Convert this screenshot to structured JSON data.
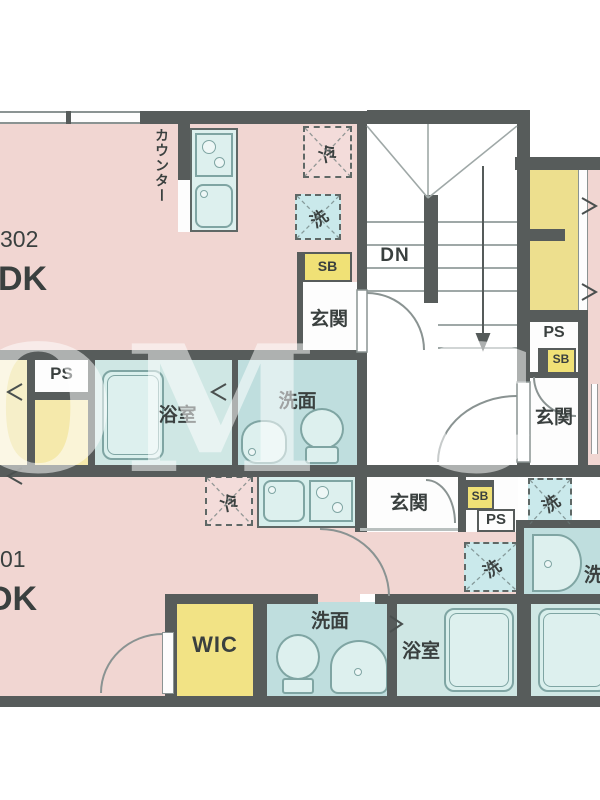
{
  "units": {
    "u302": {
      "number": "302",
      "plan": "DK"
    },
    "u301": {
      "number": "01",
      "plan": "DK"
    }
  },
  "rooms": {
    "genkan": "玄関",
    "bathroom": "浴室",
    "washroom": "洗面",
    "wic": "WIC",
    "counter": "カウンター"
  },
  "fixtures": {
    "fridge": "冷",
    "washer": "洗",
    "shoebox": "SB",
    "pipe_space": "PS",
    "stairs_down": "DN"
  },
  "watermark": "OM C",
  "colors": {
    "wall": "#575c5b",
    "room_pink": "#f1d6d2",
    "bath_cyan": "#cfe7e4",
    "washroom_cyan": "#bfdede",
    "shoebox_yellow": "#f0e176",
    "closet_yellow": "#eddf8e",
    "wic_yellow": "#f2e385"
  }
}
